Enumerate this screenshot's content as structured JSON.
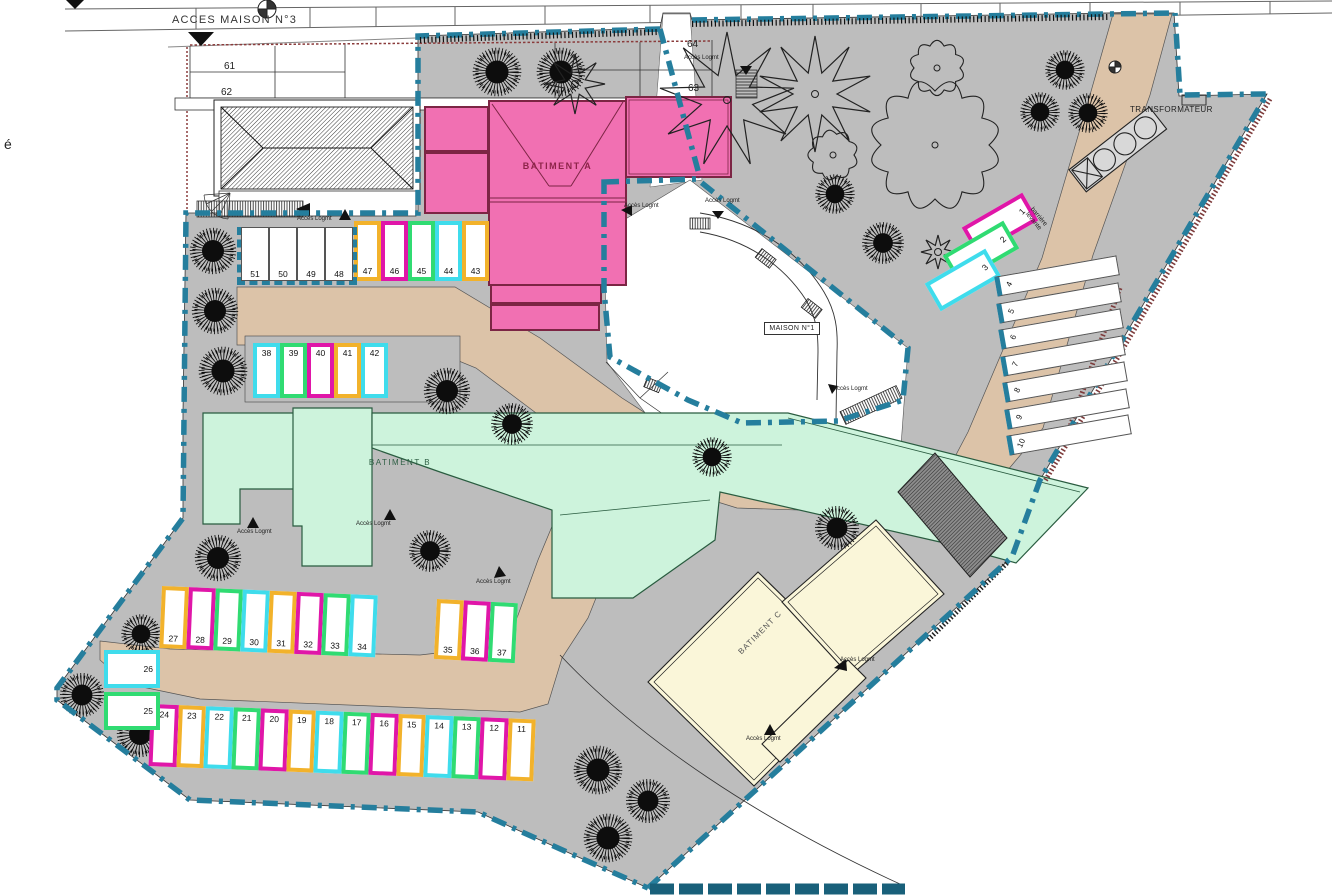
{
  "labels": {
    "acces_maison": "ACCES MAISON N°3",
    "transformateur": "TRANSFORMATEUR",
    "maison_n1": "MAISON N°1",
    "batiment_a": "BATIMENT A",
    "batiment_b": "BATIMENT B",
    "batiment_c": "BATIMENT C",
    "barriere_levante": "barrière levante",
    "acces_logmt": "Accès Logmt",
    "side_letter": "é"
  },
  "plots": {
    "p61": "61",
    "p62": "62",
    "p63": "63",
    "p64": "64"
  },
  "colors": {
    "magenta": "#e016a8",
    "orange": "#f2b22b",
    "cyan": "#3fdcec",
    "green": "#30db72",
    "white": "#ffffff",
    "boundary": "#257e9d",
    "boundary_dark": "#19607a",
    "road_tan": "#dcc3a8",
    "paving_gray": "#bdbdbd",
    "batiment_a_fill": "#f170b2",
    "batiment_a_border": "#7c2544",
    "batiment_b_fill": "#cdf3dc",
    "batiment_b_border": "#2a5c40",
    "batiment_c_fill": "#faf6d9",
    "tree_black": "#0d0d0d",
    "red_hatch": "#7d3b3b"
  },
  "parking": {
    "rows": [
      {
        "id": "row-47-43",
        "numbers": [
          "47",
          "46",
          "45",
          "44",
          "43"
        ],
        "colors": [
          "orange",
          "magenta",
          "green",
          "cyan",
          "orange"
        ],
        "number_pos": "bottom"
      },
      {
        "id": "row-51-48",
        "numbers": [
          "51",
          "50",
          "49",
          "48"
        ],
        "colors": [
          "white",
          "white",
          "white",
          "white"
        ],
        "number_pos": "bottom"
      },
      {
        "id": "row-38-42",
        "numbers": [
          "38",
          "39",
          "40",
          "41",
          "42"
        ],
        "colors": [
          "cyan",
          "green",
          "magenta",
          "orange",
          "cyan"
        ],
        "number_pos": "top"
      },
      {
        "id": "row-27-34",
        "numbers": [
          "27",
          "28",
          "29",
          "30",
          "31",
          "32",
          "33",
          "34"
        ],
        "colors": [
          "orange",
          "magenta",
          "green",
          "cyan",
          "orange",
          "magenta",
          "green",
          "cyan"
        ],
        "number_pos": "bottom"
      },
      {
        "id": "row-35-37",
        "numbers": [
          "35",
          "36",
          "37"
        ],
        "colors": [
          "orange",
          "magenta",
          "green"
        ],
        "number_pos": "bottom"
      },
      {
        "id": "row-26-25",
        "numbers": [
          "26",
          "25"
        ],
        "colors": [
          "cyan",
          "green"
        ],
        "number_pos": "right"
      },
      {
        "id": "row-24-11",
        "numbers": [
          "24",
          "23",
          "22",
          "21",
          "20",
          "19",
          "18",
          "17",
          "16",
          "15",
          "14",
          "13",
          "12",
          "11"
        ],
        "colors": [
          "magenta",
          "orange",
          "cyan",
          "green",
          "magenta",
          "orange",
          "cyan",
          "green",
          "magenta",
          "orange",
          "cyan",
          "green",
          "magenta",
          "orange"
        ],
        "number_pos": "top"
      },
      {
        "id": "row-1-3",
        "numbers": [
          "1",
          "2",
          "3"
        ],
        "colors": [
          "magenta",
          "green",
          "cyan"
        ],
        "number_pos": "right"
      },
      {
        "id": "row-4-10",
        "numbers": [
          "4",
          "5",
          "6",
          "7",
          "8",
          "9",
          "10"
        ],
        "colors": [
          "white",
          "white",
          "white",
          "white",
          "white",
          "white",
          "white"
        ],
        "number_pos": "left-rot"
      }
    ]
  }
}
